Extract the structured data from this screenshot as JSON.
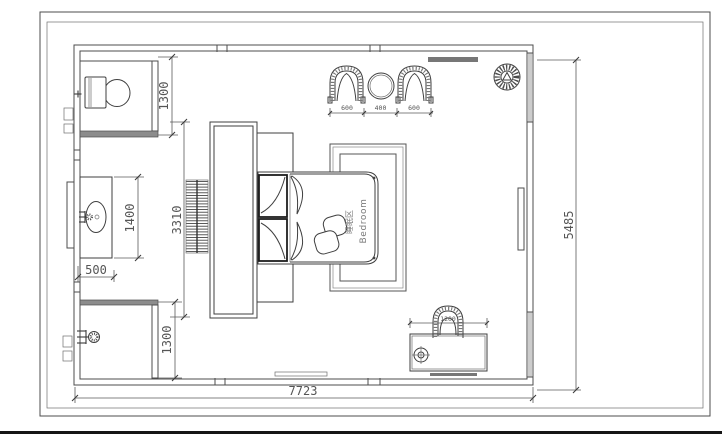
{
  "plan": {
    "room_label": {
      "zh": "睡眠区",
      "en": "Bedroom"
    },
    "dimensions": {
      "toilet_depth": "1300",
      "shower_depth": "1300",
      "vanity_length": "1400",
      "vanity_depth": "500",
      "headboard_wall": "3310",
      "armchair_left": "600",
      "side_table": "400",
      "armchair_right": "600",
      "dressing_desk": "1200",
      "overall_width": "7723",
      "overall_depth": "5485"
    },
    "colors": {
      "background": "#ffffff",
      "linework": "#4c4c4c",
      "dimension_text": "#555555",
      "wall_dark_fill": "#8c8c8c",
      "wall_light_fill": "#bdbdbd"
    }
  }
}
